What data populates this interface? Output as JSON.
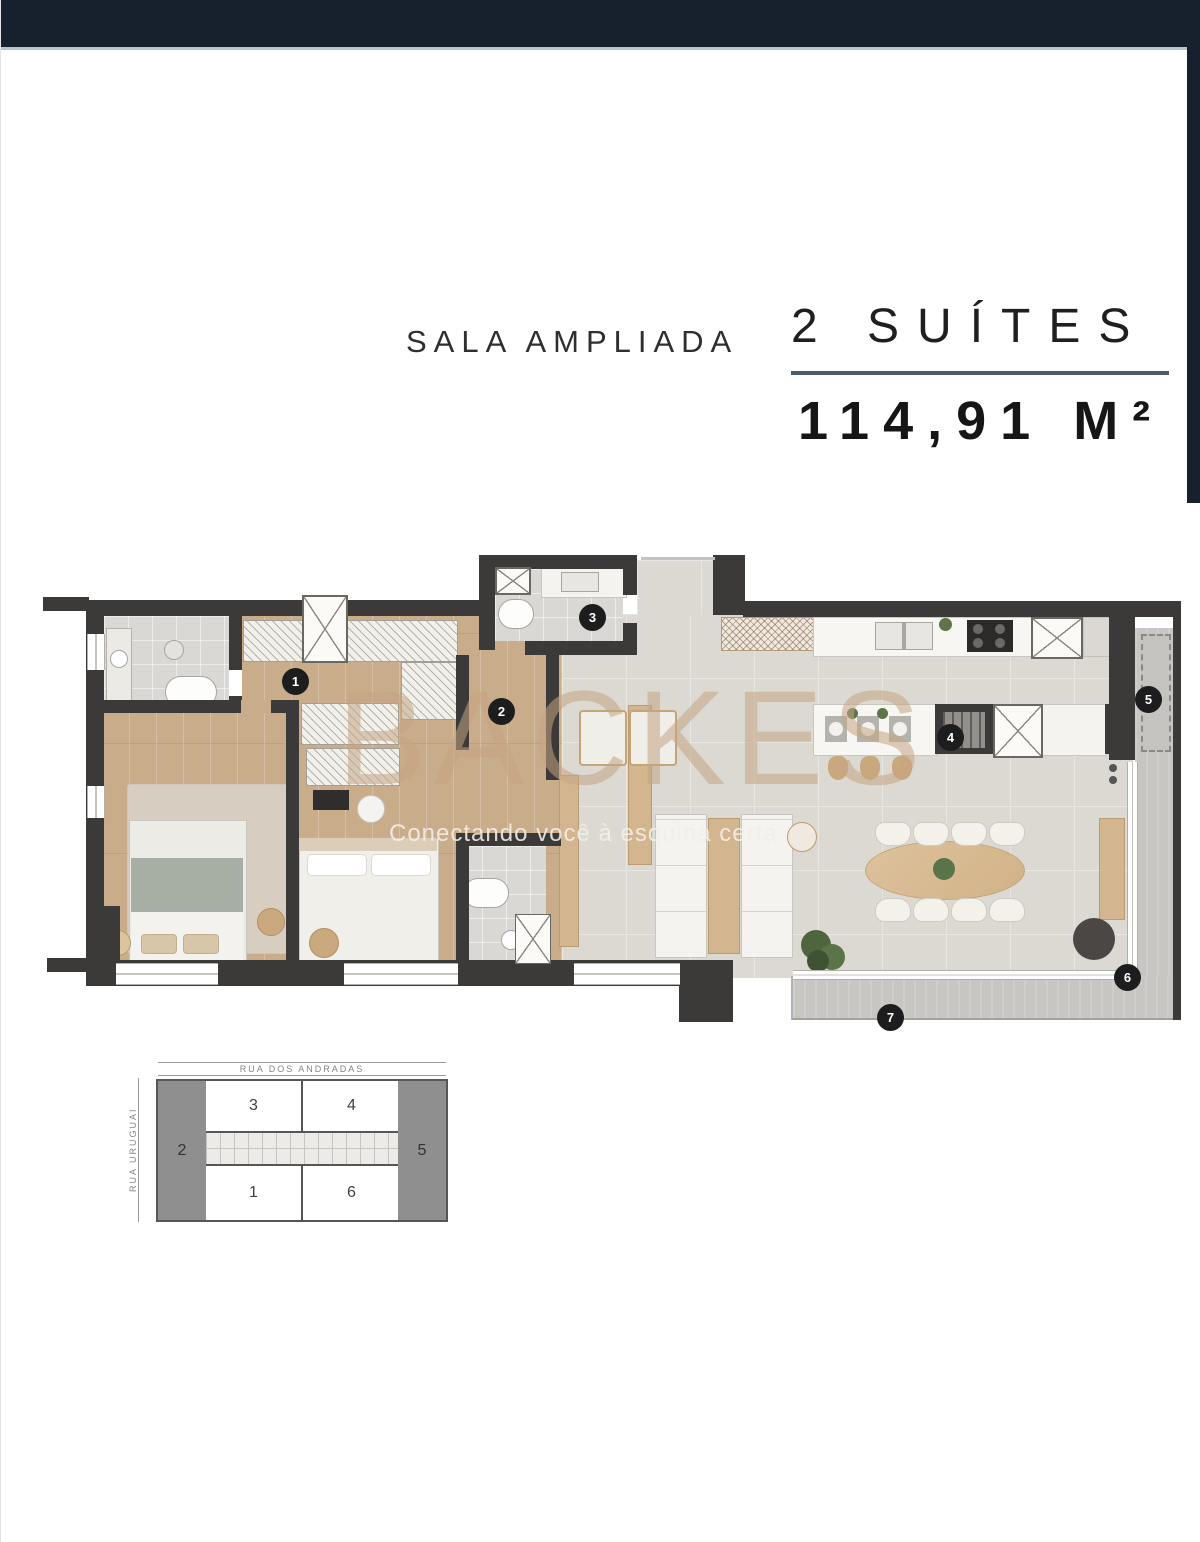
{
  "titles": {
    "plan_name": "SALA AMPLIADA",
    "suites": "2 SUÍTES",
    "area": "114,91 M²"
  },
  "watermark": {
    "brand": "BACKES",
    "tagline": "Conectando você à esquina certa"
  },
  "floor_plan": {
    "markers": [
      {
        "label": "1"
      },
      {
        "label": "2"
      },
      {
        "label": "3"
      },
      {
        "label": "4"
      },
      {
        "label": "5"
      },
      {
        "label": "6"
      },
      {
        "label": "7"
      }
    ]
  },
  "key_plan": {
    "street_top": "RUA DOS ANDRADAS",
    "street_left": "RUA URUGUAI",
    "units": {
      "left": "2",
      "right": "5",
      "top_left": "3",
      "top_right": "4",
      "bottom_left": "1",
      "bottom_right": "6"
    }
  },
  "colors": {
    "top_bar": "#16212d",
    "underline": "#4d5c69",
    "wall": "#3b3a38",
    "wood_floor": "#c9ac8a",
    "tile_floor": "#dcd9d2",
    "balcony": "#c7c6c2",
    "marker_bg": "#1d1d1d",
    "watermark": "#c4a483"
  }
}
